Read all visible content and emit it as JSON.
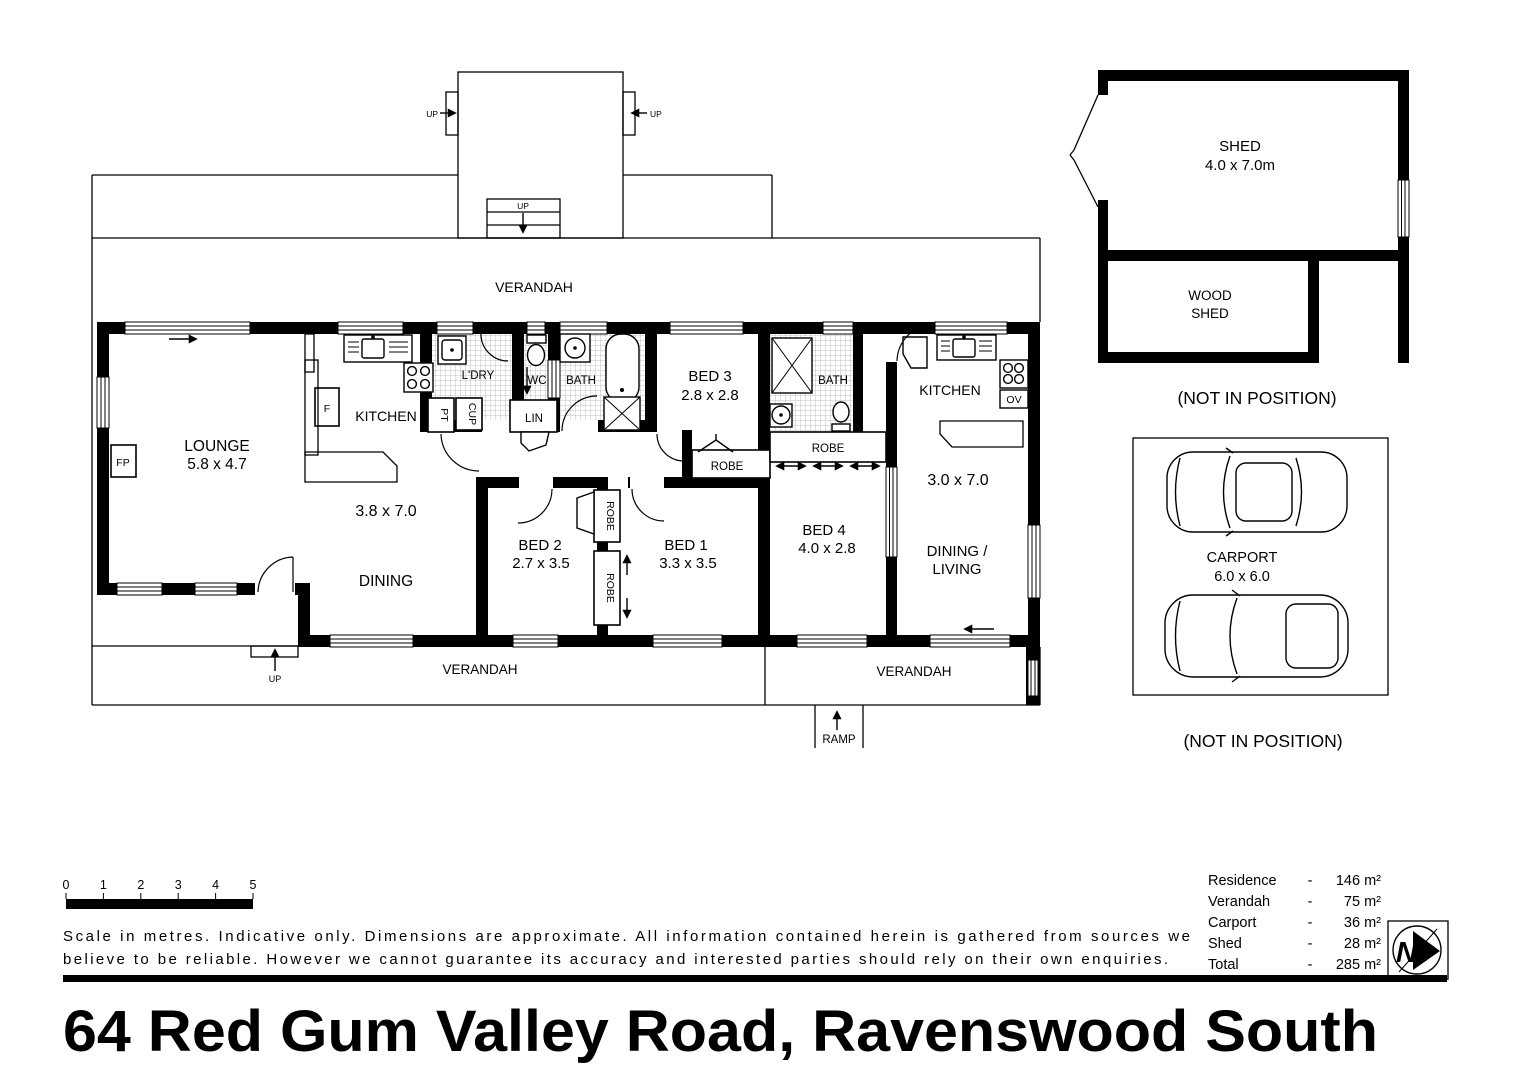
{
  "title": "64 Red Gum Valley Road, Ravenswood South",
  "plan": {
    "verandah_label": "VERANDAH",
    "ramp_label": "RAMP",
    "up_label": "UP",
    "robe_label": "ROBE",
    "bath_label": "BATH",
    "wc_label": "WC",
    "laundry_label": "L'DRY",
    "linen_label": "LIN",
    "pantry_label": "PT",
    "cupboard_label": "CUP",
    "fireplace_label": "FP",
    "fridge_label": "F",
    "oven_label": "OV",
    "kitchen_label": "KITCHEN",
    "dining_label": "DINING",
    "rooms": {
      "lounge": {
        "name": "LOUNGE",
        "dims": "5.8 x 4.7"
      },
      "kitchen_dining": {
        "dims": "3.8 x 7.0"
      },
      "bed1": {
        "name": "BED 1",
        "dims": "3.3 x 3.5"
      },
      "bed2": {
        "name": "BED 2",
        "dims": "2.7 x 3.5"
      },
      "bed3": {
        "name": "BED 3",
        "dims": "2.8 x 2.8"
      },
      "bed4": {
        "name": "BED 4",
        "dims": "4.0 x 2.8"
      },
      "dining_living": {
        "name_line1": "DINING /",
        "name_line2": "LIVING",
        "dims": "3.0 x 7.0"
      }
    }
  },
  "outbuildings": {
    "shed": {
      "name": "SHED",
      "dims": "4.0 x 7.0m"
    },
    "wood_shed": {
      "name_line1": "WOOD",
      "name_line2": "SHED"
    },
    "carport": {
      "name": "CARPORT",
      "dims": "6.0 x 6.0"
    },
    "not_in_position_label": "(NOT IN POSITION)"
  },
  "scale_bar": {
    "ticks": [
      "0",
      "1",
      "2",
      "3",
      "4",
      "5"
    ]
  },
  "disclaimer": {
    "line1": "Scale in metres. Indicative only. Dimensions are approximate. All information contained herein is gathered from sources we",
    "line2": "believe to be reliable. However we cannot guarantee  its accuracy and interested parties should rely on their own enquiries."
  },
  "area_summary": {
    "separator": "-",
    "rows": [
      {
        "label": "Residence",
        "value": "146 m²"
      },
      {
        "label": "Verandah",
        "value": "75 m²"
      },
      {
        "label": "Carport",
        "value": "36 m²"
      },
      {
        "label": "Shed",
        "value": "28 m²"
      },
      {
        "label": "Total",
        "value": "285 m²"
      }
    ]
  },
  "compass": {
    "letter": "N"
  }
}
